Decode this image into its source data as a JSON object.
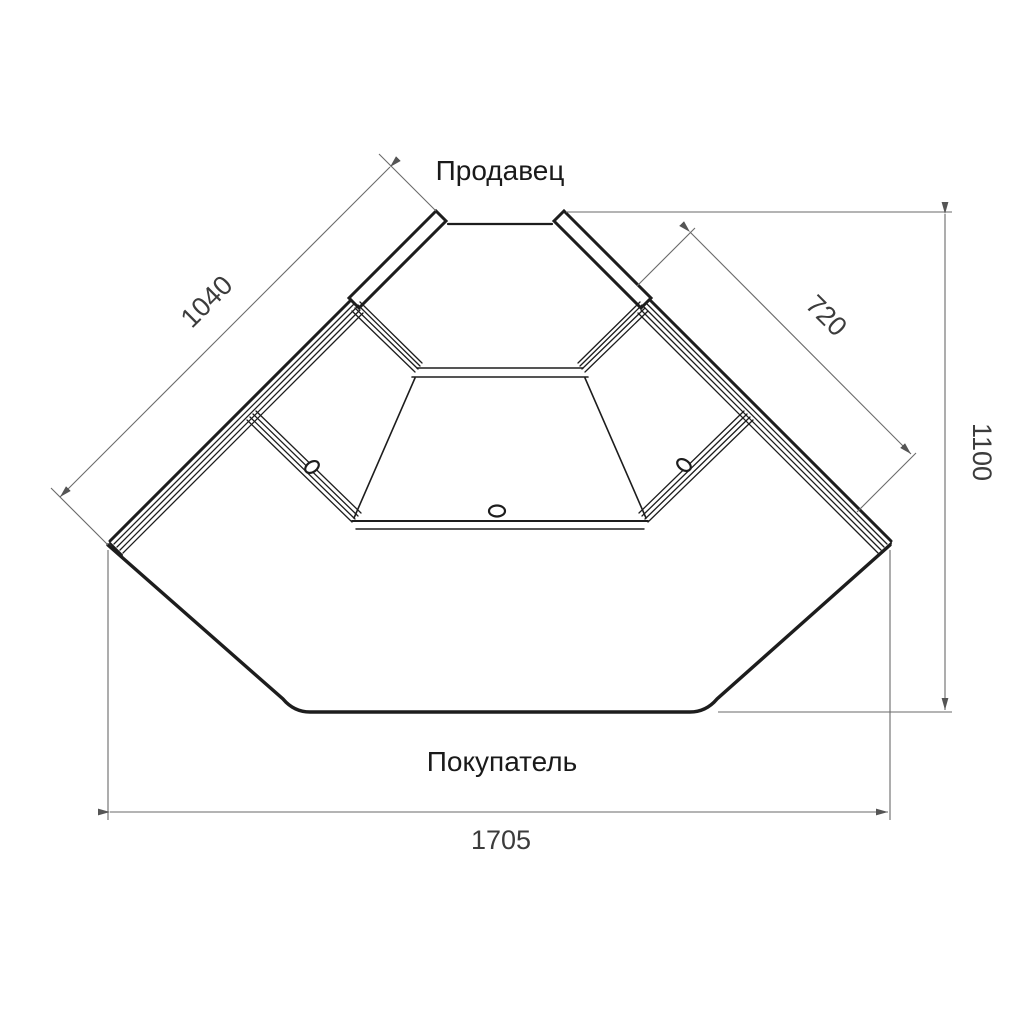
{
  "drawing": {
    "labels": {
      "seller": "Продавец",
      "buyer": "Покупатель"
    },
    "dimensions": {
      "left_glass": "1040",
      "right_glass": "720",
      "depth": "1100",
      "front_width": "1705"
    },
    "colors": {
      "background": "#ffffff",
      "outline": "#1d1d1d",
      "dimension_line": "#6a6a6a",
      "text": "#1a1a1a"
    }
  }
}
